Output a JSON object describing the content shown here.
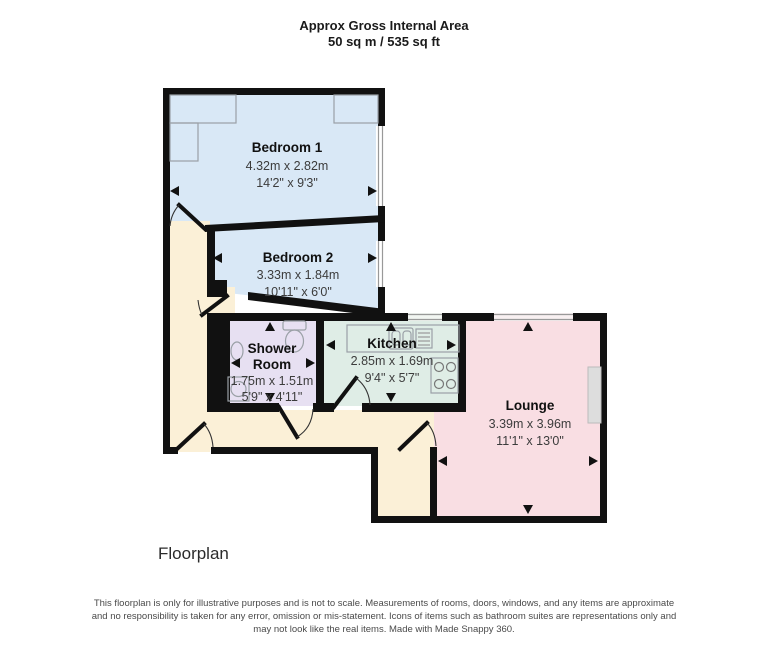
{
  "header": {
    "line1": "Approx Gross Internal Area",
    "line2": "50 sq m / 535 sq ft"
  },
  "rooms": {
    "bedroom1": {
      "name": "Bedroom 1",
      "metric": "4.32m x 2.82m",
      "imperial": "14'2\" x 9'3\""
    },
    "bedroom2": {
      "name": "Bedroom 2",
      "metric": "3.33m x 1.84m",
      "imperial": "10'11\" x 6'0\""
    },
    "shower": {
      "name_line1": "Shower",
      "name_line2": "Room",
      "metric": "1.75m x 1.51m",
      "imperial": "5'9\" x 4'11\""
    },
    "kitchen": {
      "name": "Kitchen",
      "metric": "2.85m x 1.69m",
      "imperial": "9'4\" x 5'7\""
    },
    "lounge": {
      "name": "Lounge",
      "metric": "3.39m x 3.96m",
      "imperial": "11'1\" x 13'0\""
    }
  },
  "caption": "Floorplan",
  "footer": {
    "line1": "This floorplan is only for illustrative purposes and is not to scale. Measurements of rooms, doors, windows, and any items are approximate",
    "line2": "and no responsibility is taken for any error, omission or mis-statement. Icons of items such as bathroom suites are representations only and",
    "line3": "may not look like the real items. Made with Made Snappy 360."
  },
  "colors": {
    "bedroom": "#d9e8f6",
    "shower": "#e7e0f2",
    "kitchen": "#dfede6",
    "lounge": "#f9dee3",
    "hallway": "#fbf0d7",
    "wall": "#111111"
  }
}
